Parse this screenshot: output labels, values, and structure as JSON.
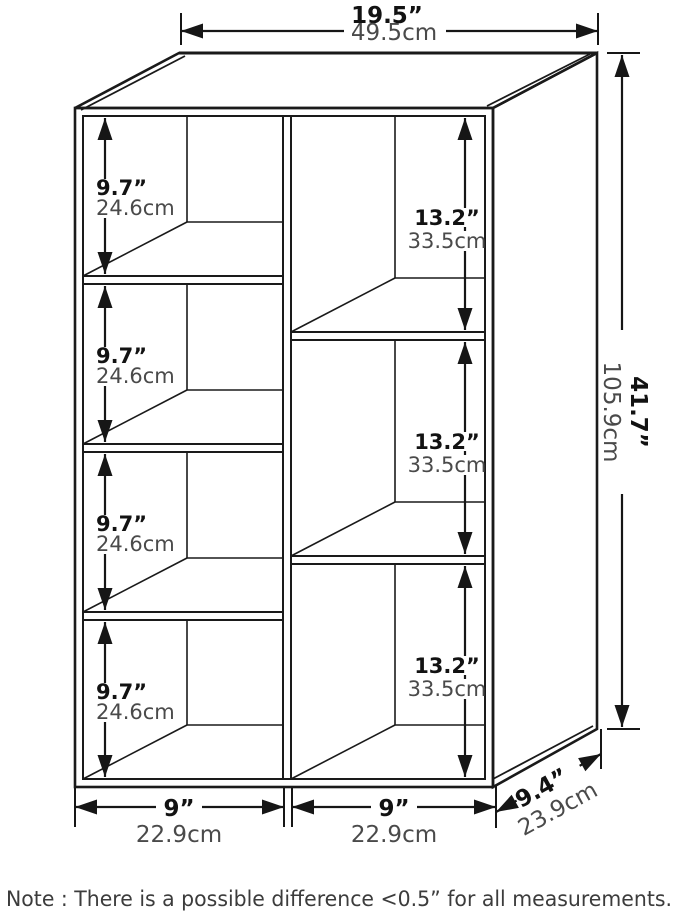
{
  "dims": {
    "width": {
      "in": "19.5”",
      "cm": "49.5cm"
    },
    "height": {
      "in": "41.7”",
      "cm": "105.9cm"
    },
    "depth": {
      "in": "9.4”",
      "cm": "23.9cm"
    },
    "left_column": {
      "in": "9”",
      "cm": "22.9cm"
    },
    "right_column": {
      "in": "9”",
      "cm": "22.9cm"
    },
    "left_cubbies": [
      {
        "in": "9.7”",
        "cm": "24.6cm"
      },
      {
        "in": "9.7”",
        "cm": "24.6cm"
      },
      {
        "in": "9.7”",
        "cm": "24.6cm"
      },
      {
        "in": "9.7”",
        "cm": "24.6cm"
      }
    ],
    "right_cubbies": [
      {
        "in": "13.2”",
        "cm": "33.5cm"
      },
      {
        "in": "13.2”",
        "cm": "33.5cm"
      },
      {
        "in": "13.2”",
        "cm": "33.5cm"
      }
    ]
  },
  "note": "Note : There is a possible difference <0.5” for all measurements.",
  "colors": {
    "line": "#1a1a1a",
    "text_primary": "#121212",
    "text_secondary": "#4a4a4a",
    "background": "#ffffff"
  }
}
